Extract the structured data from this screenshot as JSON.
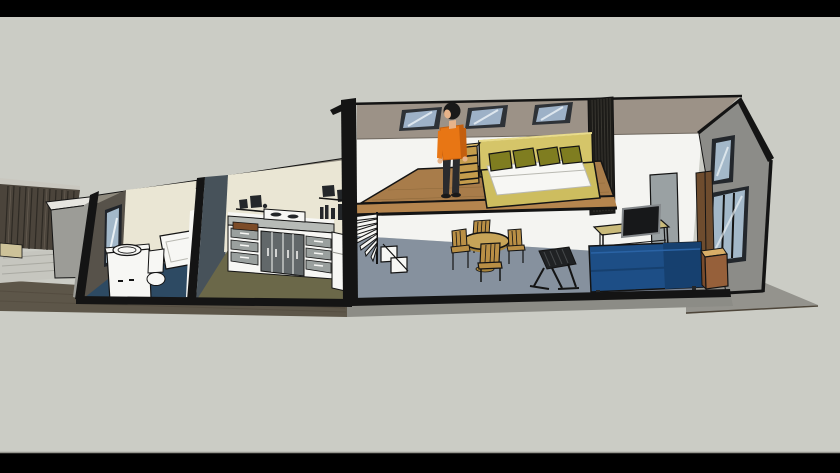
{
  "meta": {
    "application": "3d-model-viewport",
    "view": "SketchUp-style cutaway section of a long narrow house, viewed from the front in perspective",
    "visible_text": ""
  },
  "colors": {
    "letterbox": "#000000",
    "bg": "#cbccc5",
    "outline": "#141414",
    "edge_line": "#96968f",
    "shadow_plane": "#94938d",
    "terrace": "#5d5649",
    "terrace_line": "#4e463a",
    "foundation": "#8c8c86",
    "paving": "#c6c6bf",
    "paving_line": "#a9a9a2",
    "fence": "#4b443b",
    "fence_slat": "#2e2a24",
    "fence_slat_light": "#6b6257",
    "fence_cap": "#c9c7bf",
    "planter_top": "#e6e5e0",
    "planter_front": "#9c9c97",
    "ledge": "#cdc299",
    "wall_top": "#8e897d",
    "bath_wall": "#57524a",
    "cream": "#eae6d4",
    "bath_floor": "#2d4a63",
    "white": "#f7f7f4",
    "mirror_frame": "#20242a",
    "glass": "#a3b8c9",
    "glass_streak": "#e9f0f4",
    "door_panel": "#47525a",
    "kitchen_floor": "#6b6849",
    "counter_top": "#b7bbb7",
    "drawer": "#9aa09e",
    "cabinet_door": "#62686a",
    "board": "#7c4b27",
    "dark_item": "#24272a",
    "roof": "#9c9287",
    "roof_edge": "#6f685f",
    "sky_frame": "#2e3237",
    "sky_glass": "#9db1c7",
    "dark_wall": "#1c1b18",
    "dark_wall_slat": "#383630",
    "loft_floor": "#a87c4a",
    "plank_line": "#8f6a3c",
    "slab": "#b5854e",
    "wall_white": "#f4f4f1",
    "lower_floor": "#86919e",
    "floor_shadow": "#747f8e",
    "chair_wood": "#b98f45",
    "table_top": "#c7a458",
    "table_base": "#a8853d",
    "dark_chair": "#202224",
    "dark_chair_slat": "#45484a",
    "panel": "#9aa1a3",
    "desk": "#c9ba7a",
    "screen": "#17181a",
    "screen_frame": "#85898c",
    "wardrobe": "#6e4c2e",
    "sofa": "#1d4e86",
    "sofa_shade": "#16406f",
    "sofa_top": "#2a63a5",
    "box_top": "#d9ae67",
    "box_front": "#96603a",
    "box_side": "#7a4c2c",
    "bed_khaki": "#d5c569",
    "bed_frame": "#cdbd5f",
    "bed_light": "#e9dc8c",
    "pillow": "#7f7d20",
    "mattress_line": "#b9b9b2",
    "shelf_wood": "#c49c4c",
    "shelf_top": "#dbb96a",
    "pants": "#2a2b2e",
    "shirt": "#e87614",
    "shirt_shade": "#c45f0e",
    "skin": "#e7b389",
    "hair": "#191919",
    "gable": "#8c8c88",
    "window_frame": "#23272c"
  },
  "scene": {
    "style": "sketchup-cutaway",
    "wings": [
      {
        "name": "service-wing",
        "storeys": 1,
        "rooms": [
          {
            "name": "bathroom",
            "floor_color_key": "bath_floor",
            "objects": [
              "wall-mirror",
              "vanity-with-round-sink",
              "toilet",
              "bathtub"
            ]
          },
          {
            "name": "kitchen",
            "floor_color_key": "kitchen_floor",
            "objects": [
              "counter-with-drawers",
              "dark-cabinet-doors",
              "cooktop",
              "cutting-board",
              "wall-shelves",
              "small-appliances",
              "fridge"
            ]
          }
        ]
      },
      {
        "name": "living-wing",
        "storeys": 2,
        "rooms": [
          {
            "name": "living-room",
            "floor_color_key": "lower_floor",
            "objects": [
              "spiral-staircase",
              "round-dining-table",
              "four-wooden-chairs",
              "dark-rocking-chair",
              "desk-with-monitor",
              "divider-panel",
              "blue-sofa",
              "storage-cube",
              "wardrobe"
            ]
          },
          {
            "name": "loft-bedroom",
            "floor_color_key": "loft_floor",
            "objects": [
              "standing-person-orange-shirt",
              "bedside-ladder-chest",
              "double-bed-with-four-olive-pillows",
              "dark-slatted-wardrobe-wall",
              "three-skylights"
            ]
          }
        ],
        "gable": {
          "windows": [
            "tall-upper-window",
            "three-pane-lower-window"
          ]
        }
      }
    ],
    "exterior": [
      "deck-fence",
      "patio-planter",
      "paved-patio",
      "terrace-strip",
      "foundation-strip",
      "driveway-shadow-plane"
    ]
  }
}
